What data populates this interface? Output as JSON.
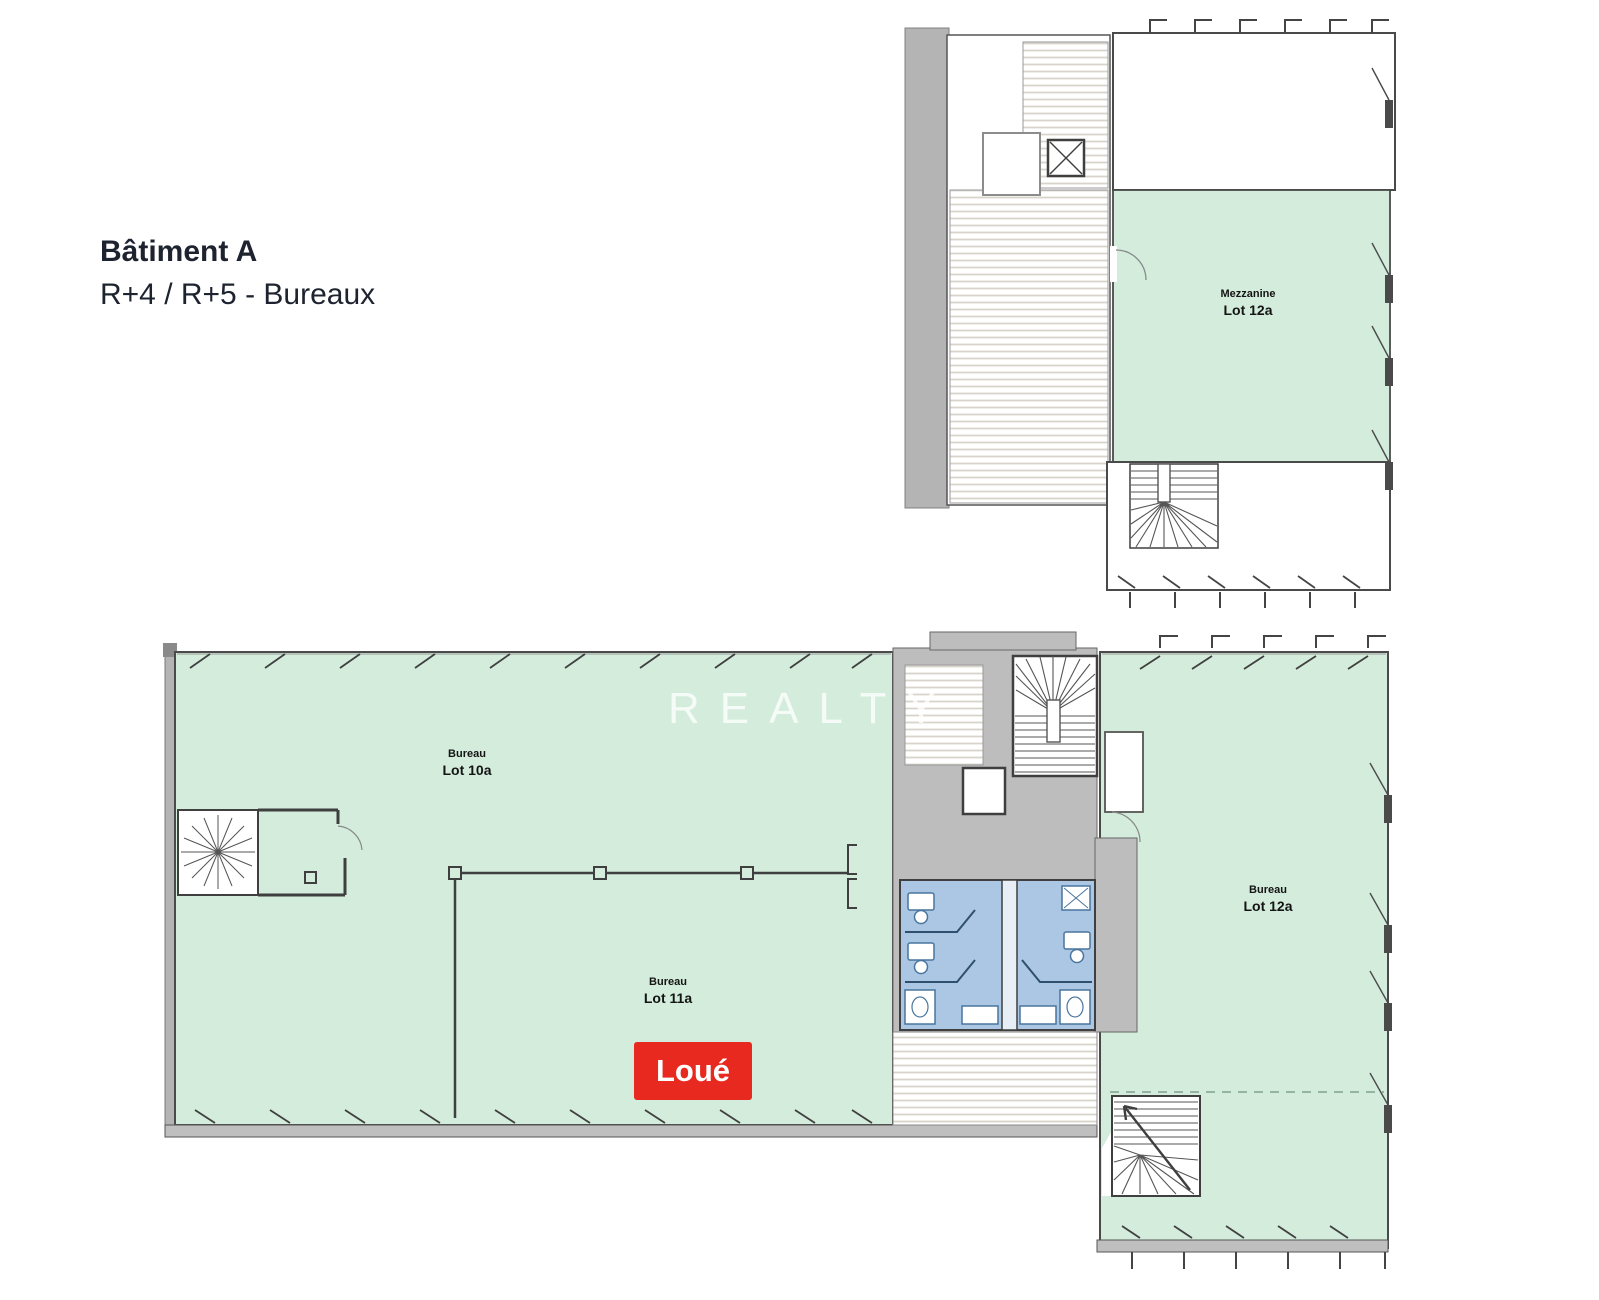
{
  "header": {
    "title": "Bâtiment A",
    "subtitle": "R+4 / R+5 - Bureaux"
  },
  "watermark": "REALTY",
  "badge": {
    "label": "Loué"
  },
  "upper_plan": {
    "floor": "R+5",
    "room_label": {
      "line1": "Mezzanine",
      "line2": "Lot 12a"
    }
  },
  "lower_plan": {
    "floor": "R+4",
    "rooms": [
      {
        "line1": "Bureau",
        "line2": "Lot 10a"
      },
      {
        "line1": "Bureau",
        "line2": "Lot 11a"
      },
      {
        "line1": "Bureau",
        "line2": "Lot 12a"
      }
    ]
  },
  "colors": {
    "office_green": "#d3ecdc",
    "circulation_gray": "#bdbdbd",
    "sanitary_blue": "#abc7e3",
    "rented_red": "#e8291f",
    "wall_dark": "#3f3f3f"
  }
}
